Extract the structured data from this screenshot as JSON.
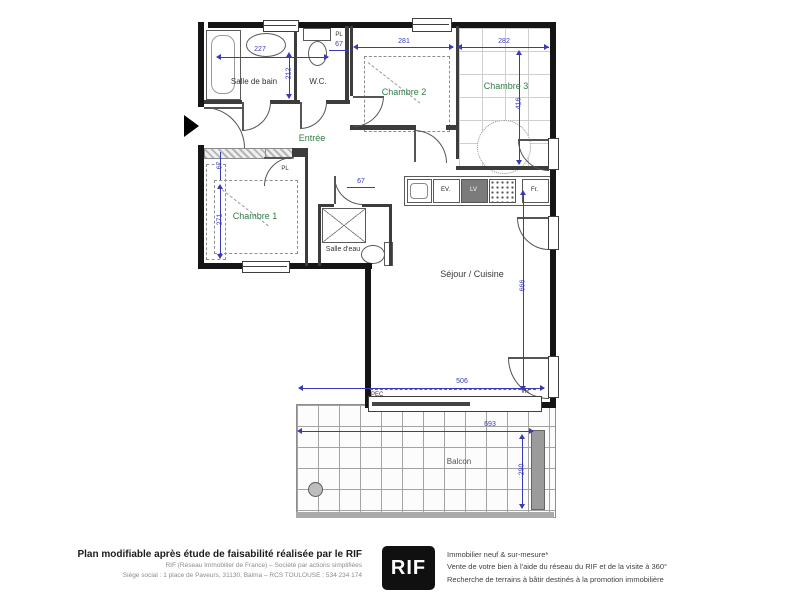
{
  "plan": {
    "rooms": {
      "salle_de_bain": "Salle de bain",
      "wc": "W.C.",
      "entree": "Entrée",
      "chambre1": "Chambre 1",
      "chambre2": "Chambre 2",
      "chambre3": "Chambre 3",
      "salle_deau": "Salle d'eau",
      "sejour": "Séjour / Cuisine",
      "balcon": "Balcon"
    },
    "dimensions": {
      "sdb_width": "227",
      "sdb_height": "212",
      "wc_placard_width": "67",
      "ch2_width": "281",
      "ch3_width": "282",
      "ch3_height": "416",
      "placard_height": "67",
      "ch1_height": "271",
      "couloir_width": "67",
      "sejour_width": "506",
      "sejour_height": "666",
      "balcon_width": "693",
      "balcon_height": "290"
    },
    "annotations": {
      "placard": "PL",
      "evier": "EV.",
      "lave_vaisselle": "LV",
      "frigo": "Fr.",
      "volet_roulant": "VR",
      "pec": "PEC"
    },
    "colors": {
      "dimension_blue": "#3a3ab8",
      "room_label_green": "#2f7a46",
      "wall_black": "#151515"
    }
  },
  "footer": {
    "title": "Plan modifiable après étude de faisabilité réalisée par le RIF",
    "company_line1": "RIF (Réseau Immobilier de France) – Société par actions simplifiées",
    "company_line2": "Siège social : 1 place de Paveurs, 31130, Balma – RCS TOULOUSE : 534 234 174",
    "logo_text": "RIF",
    "services": [
      "Immobilier neuf & sur-mesure*",
      "Vente de votre bien à l'aide du réseau du RIF et de la visite à 360°",
      "Recherche de terrains à bâtir destinés à la promotion immobilière"
    ]
  }
}
